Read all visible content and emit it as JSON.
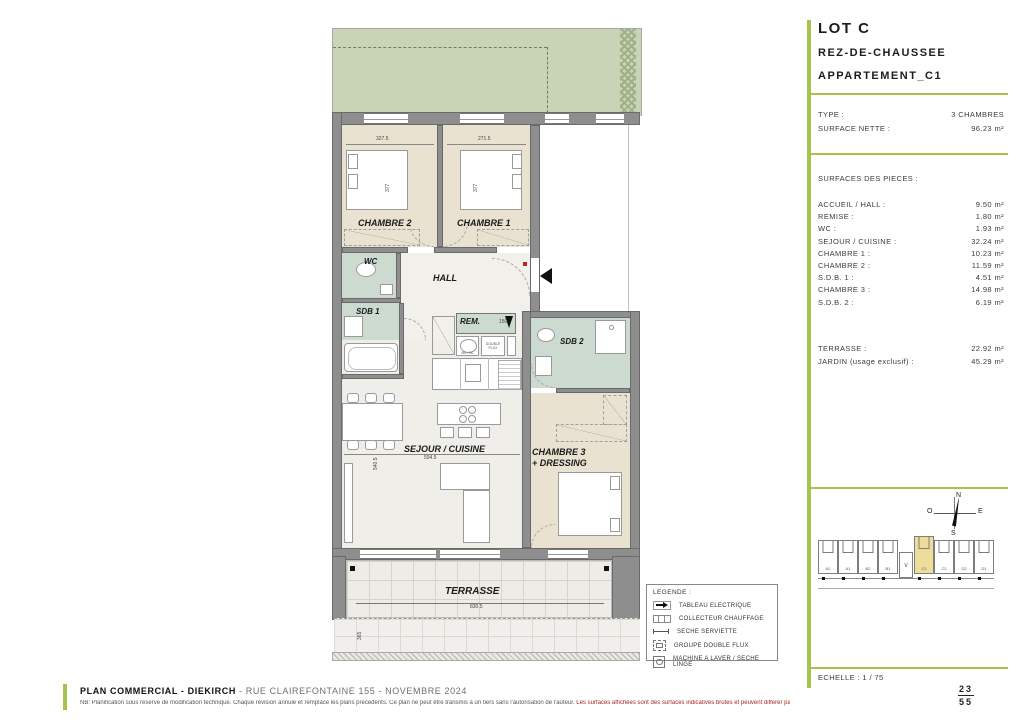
{
  "panel": {
    "lot_title": "LOT C",
    "floor_title": "REZ-DE-CHAUSSEE",
    "apartment_title": "APPARTEMENT_C1",
    "type": {
      "label": "TYPE :",
      "value": "3 CHAMBRES"
    },
    "surface_nette": {
      "label": "SURFACE NETTE :",
      "value": "96.23 m²"
    },
    "rooms_header": "SURFACES DES PIECES :",
    "rooms": [
      {
        "label": "ACCUEIL / HALL :",
        "value": "9.50 m²"
      },
      {
        "label": "REMISE :",
        "value": "1.80 m²"
      },
      {
        "label": "WC :",
        "value": "1.93 m²"
      },
      {
        "label": "SEJOUR / CUISINE :",
        "value": "32.24 m²"
      },
      {
        "label": "CHAMBRE 1 :",
        "value": "10.23 m²"
      },
      {
        "label": "CHAMBRE 2 :",
        "value": "11.59 m²"
      },
      {
        "label": "S.D.B. 1 :",
        "value": "4.51 m²"
      },
      {
        "label": "CHAMBRE 3 :",
        "value": "14.98 m²"
      },
      {
        "label": "S.D.B. 2 :",
        "value": "6.19 m²"
      }
    ],
    "outdoor": [
      {
        "label": "TERRASSE :",
        "value": "22.92 m²"
      },
      {
        "label": "JARDIN (usage exclusif) :",
        "value": "45.29 m²"
      }
    ],
    "compass": {
      "n": "N",
      "e": "E",
      "s": "S",
      "o": "O"
    },
    "minimap": {
      "units": [
        "A2",
        "A1",
        "B2",
        "B1",
        "C1",
        "C2",
        "D2",
        "D1"
      ],
      "highlighted": "C1",
      "stair_glyph": "∨"
    },
    "scale": "ECHELLE : 1 / 75",
    "page": {
      "current": "23",
      "total": "55"
    }
  },
  "plan": {
    "labels": {
      "chambre2": "CHAMBRE 2",
      "chambre1": "CHAMBRE 1",
      "wc": "WC",
      "hall": "HALL",
      "sdb1": "SDB 1",
      "rem": "REM.",
      "sdb2": "SDB 2",
      "sejour": "SEJOUR / CUISINE",
      "chambre3_l1": "CHAMBRE 3",
      "chambre3_l2": "+ DRESSING",
      "terrasse": "TERRASSE"
    },
    "appliances": {
      "ml_sl": "ML / SL",
      "double_flux": "DOUBLE FLUX"
    },
    "dims": {
      "chambre2_w": "327.5",
      "chambre1_w": "271.5",
      "chambre2_h": "377",
      "chambre1_h": "377",
      "rem_w": "150",
      "sejour_w": "594.5",
      "sejour_h": "540.5",
      "terrasse_w": "830.5",
      "terrasse_h": "365"
    }
  },
  "legend": {
    "title": "LEGENDE :",
    "items": [
      {
        "label": "TABLEAU ELECTRIQUE"
      },
      {
        "label": "COLLECTEUR CHAUFFAGE"
      },
      {
        "label": "SECHE SERVIETTE"
      },
      {
        "label": "GROUPE DOUBLE FLUX"
      },
      {
        "label": "MACHINE A LAVER / SECHE LINGE"
      }
    ]
  },
  "footer": {
    "title_bold": "PLAN COMMERCIAL - DIEKIRCH",
    "title_rest": " - RUE CLAIREFONTAINE 155 - NOVEMBRE 2024",
    "disclaimer_1": "NB: Planification sous réserve de modification technique. Chaque révision annule et remplace les plans précédents. Ce plan ne peut être transmis à un tiers sans l'autorisation de l'auteur. ",
    "disclaimer_2": "Les surfaces affichées sont des surfaces indicatives brutes et peuvent différer par rapport aux surfaces du cadastre vertical qui seules feront foi."
  },
  "colors": {
    "accent_green": "#a6c44d",
    "garden_green": "#c9d4b6",
    "room_tan": "#eae2d1",
    "bath_green": "#ccdad0",
    "wall_gray": "#8e8e8e",
    "highlight_yellow": "#eedc9a",
    "marker_red": "#c22222"
  }
}
